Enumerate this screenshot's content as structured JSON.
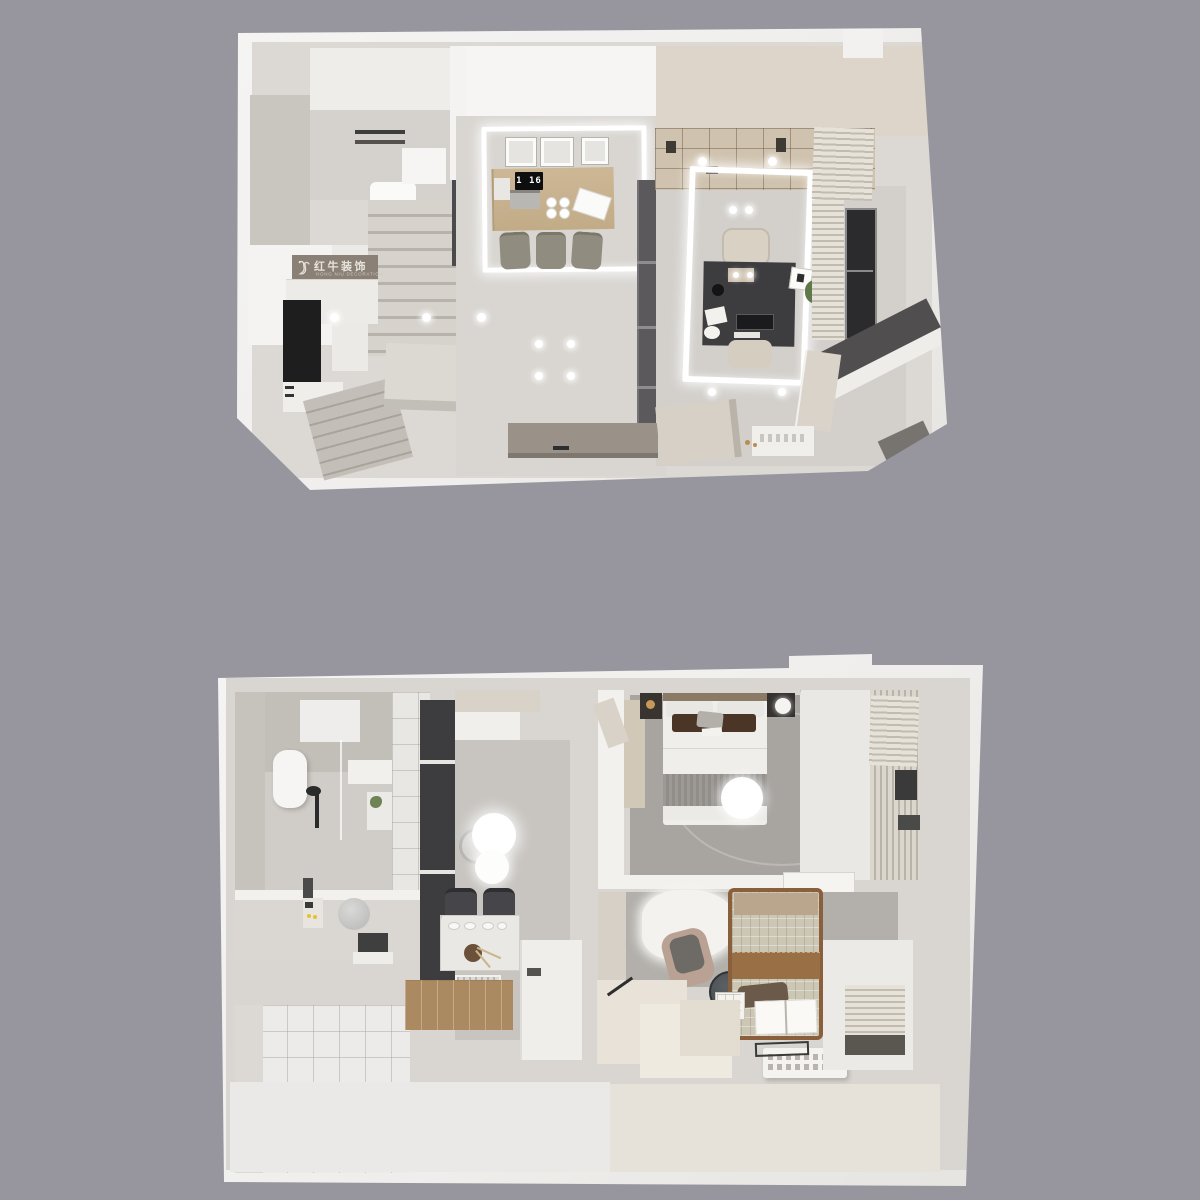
{
  "scene": {
    "background_color": "#97969e",
    "shell_color": "#f2f1ee",
    "floors_shown": 2
  },
  "branding": {
    "logo_icon": "bull-icon",
    "logo_text": "红牛装饰",
    "logo_subtext": "HONG NIU DECORATION",
    "band_color": "#8b8076"
  },
  "upper_floor": {
    "clock_text": "1 16",
    "palette": {
      "floor_marble": "#d7d4d0",
      "dining_table_wood": "#c8b192",
      "dining_chair": "#908d80",
      "wardrobe": "#5b595b",
      "desk": "#3d3d3f",
      "bookshelf": "#cfc2ae",
      "window_glass": "#2b2b2d",
      "tv_console": "#9a9289",
      "kitchen_counter": "#1e1e1e"
    }
  },
  "lower_floor": {
    "palette": {
      "hall_marble": "#c8c5c1",
      "bedroom_carpet": "#a8a5a1",
      "wood_floor": "#ab8a61",
      "bath_wall": "#c2beb8",
      "bed_pillow_brown": "#4a3526",
      "bed_plaid": "#ccc6b5",
      "leather_strap": "#996f45",
      "vanity_mirror": "#4a4f52",
      "wardrobe_dark": "#3d3d3f"
    }
  }
}
